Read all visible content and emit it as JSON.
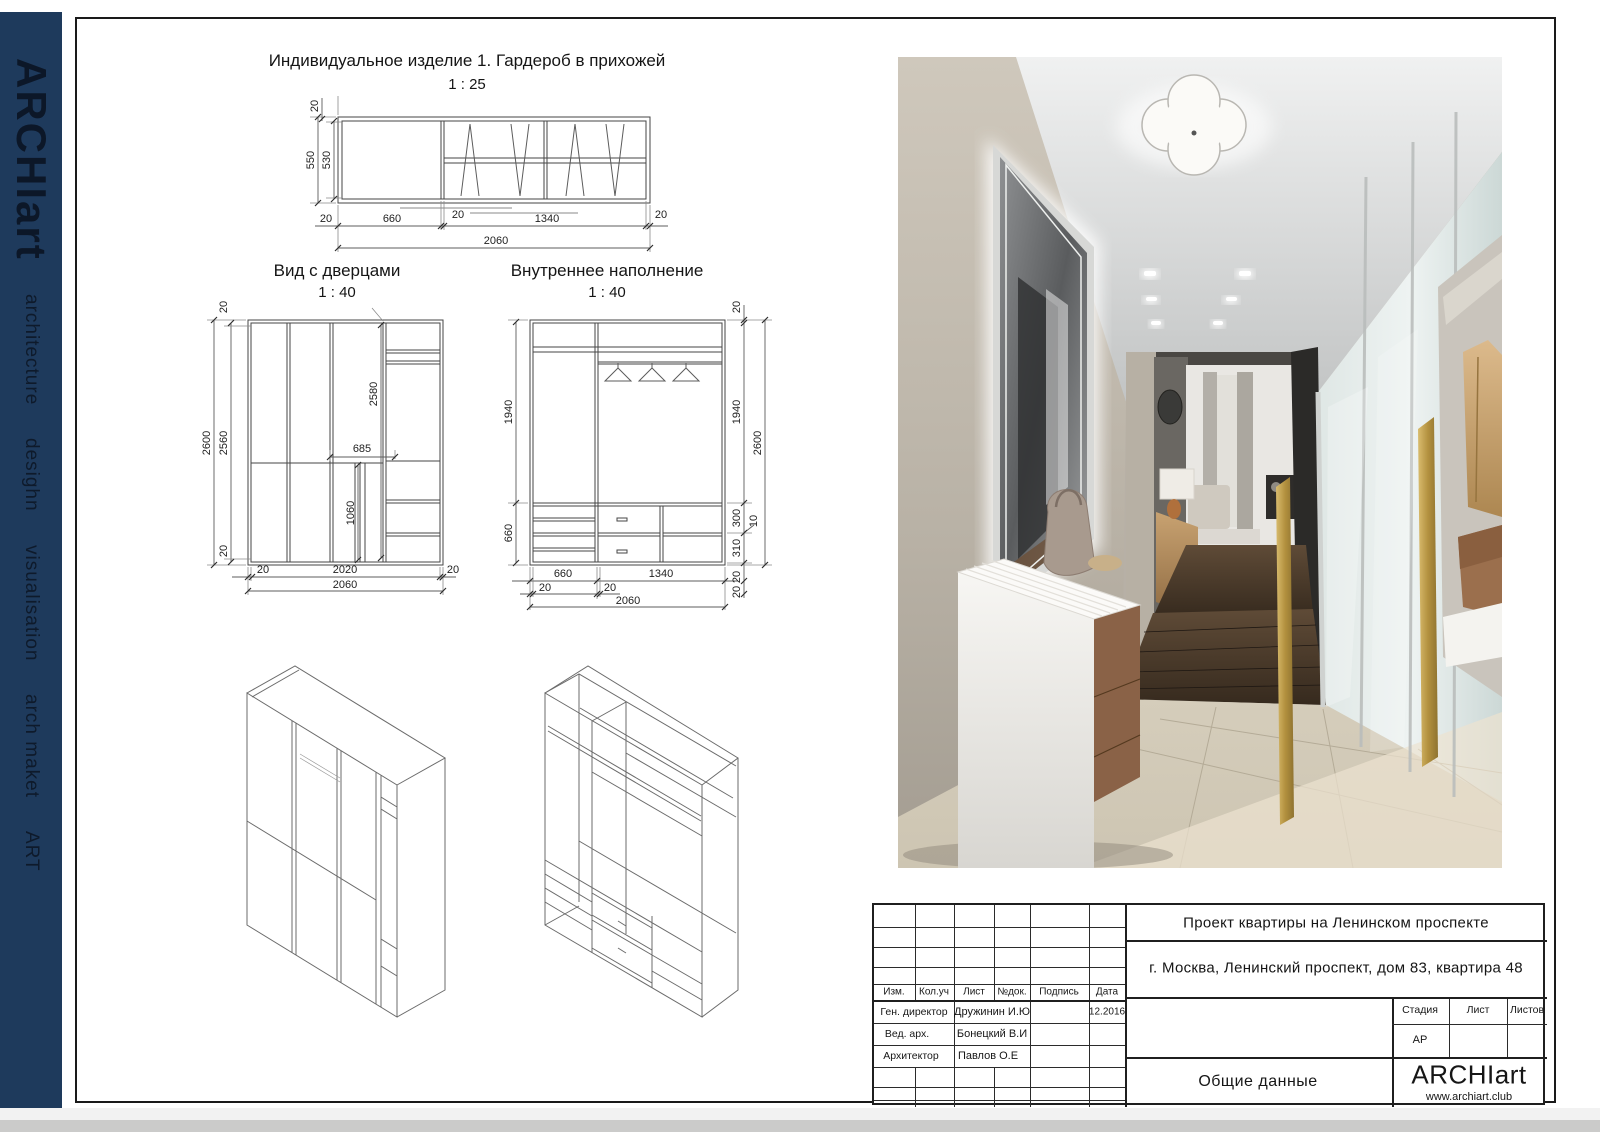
{
  "sidebar": {
    "brand": "ARCHIart",
    "items": [
      "architecture",
      "desighn",
      "visualisation",
      "arch maket",
      "ART"
    ]
  },
  "drawings": {
    "d1": {
      "title": "Индивидуальное изделие 1. Гардероб в прихожей",
      "scale": "1 : 25",
      "dims": [
        "20",
        "550",
        "530",
        "20",
        "660",
        "20",
        "1340",
        "20",
        "2060"
      ]
    },
    "d2": {
      "title": "Вид с дверцами",
      "scale": "1 : 40",
      "dims": [
        "20",
        "2600",
        "2560",
        "2580",
        "685",
        "1060",
        "20",
        "20",
        "2020",
        "20",
        "2060"
      ]
    },
    "d3": {
      "title": "Внутреннее наполнение",
      "scale": "1 : 40",
      "dims": [
        "1940",
        "660",
        "20",
        "1940",
        "2600",
        "300",
        "10",
        "310",
        "20",
        "20",
        "660",
        "1340",
        "20",
        "20",
        "2060"
      ]
    }
  },
  "titleblock": {
    "project": "Проект квартиры на Ленинском проспекте",
    "address": "г. Москва, Ленинский проспект, дом 83, квартира 48",
    "columns": [
      "Изм.",
      "Кол.уч",
      "Лист",
      "№док.",
      "Подпись",
      "Дата"
    ],
    "roles": [
      {
        "role": "Ген. директор",
        "name": "Дружинин И.Ю",
        "date": "12.2016"
      },
      {
        "role": "Вед. арх.",
        "name": "Бонецкий В.И",
        "date": ""
      },
      {
        "role": "Архитектор",
        "name": "Павлов О.Е",
        "date": ""
      }
    ],
    "stage_label": "Стадия",
    "sheet_label": "Лист",
    "sheets_label": "Листов",
    "stage_value": "АР",
    "doc_title": "Общие данные",
    "brand": "ARCHIart",
    "site": "www.archiart.club"
  },
  "colors": {
    "sidebar": "#1e3a5c",
    "gold_accent": "#c2a25c",
    "line": "#454545"
  }
}
